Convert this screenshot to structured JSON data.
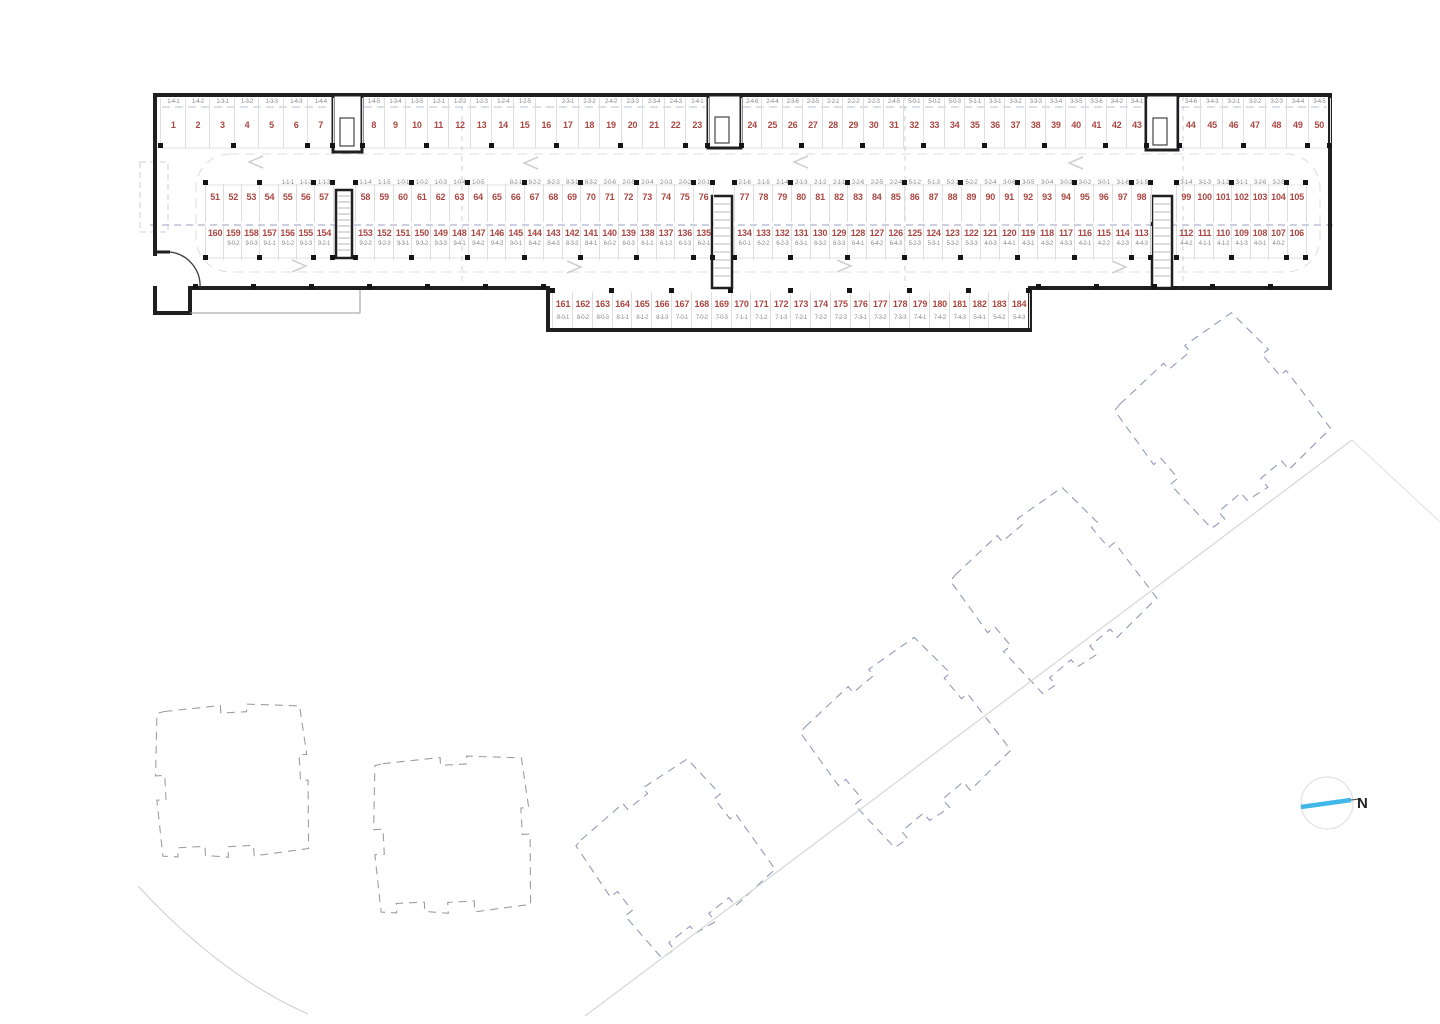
{
  "plan_type": "parking-level-floor-plan",
  "north": {
    "label": "N"
  },
  "colors": {
    "stall_number": "#ab4742",
    "unit_label": "#8c8c8c",
    "walls": "#1f1f1f",
    "stall_separator": "#dedede",
    "upper_floor_dashed": "#98a0c6",
    "site_lines": "#d4d4d4",
    "footprint_left_buildings": "#9e9e9e",
    "footprint_right_buildings": "#939aba",
    "north_arrow": "#41b6e8"
  },
  "parking": {
    "rows": [
      {
        "name": "top-row",
        "label_position": "above",
        "segments": [
          {
            "stalls": [
              {
                "n": "1",
                "u": "1-4-1"
              },
              {
                "n": "2",
                "u": "1-4-2"
              },
              {
                "n": "3",
                "u": "1-3-1"
              },
              {
                "n": "4",
                "u": "1-3-2"
              },
              {
                "n": "5",
                "u": "1-3-3"
              },
              {
                "n": "6",
                "u": "1-4-3"
              },
              {
                "n": "7",
                "u": "1-4-4"
              }
            ]
          },
          {
            "stalls": [
              {
                "n": "8",
                "u": "1-4-5"
              },
              {
                "n": "9",
                "u": "1-3-4"
              },
              {
                "n": "10",
                "u": "1-3-5"
              },
              {
                "n": "11",
                "u": "1-2-1"
              },
              {
                "n": "12",
                "u": "1-2-2"
              },
              {
                "n": "13",
                "u": "1-2-3"
              },
              {
                "n": "14",
                "u": "1-2-4"
              },
              {
                "n": "15",
                "u": "1-2-5"
              },
              {
                "n": "16",
                "u": ""
              },
              {
                "n": "17",
                "u": "2-3-1"
              },
              {
                "n": "18",
                "u": "2-3-2"
              },
              {
                "n": "19",
                "u": "2-4-2"
              },
              {
                "n": "20",
                "u": "2-3-3"
              },
              {
                "n": "21",
                "u": "2-3-4"
              },
              {
                "n": "22",
                "u": "2-4-3"
              },
              {
                "n": "23",
                "u": "2-4-1"
              }
            ]
          },
          {
            "stalls": [
              {
                "n": "24",
                "u": "2-4-6"
              },
              {
                "n": "25",
                "u": "2-4-4"
              },
              {
                "n": "26",
                "u": "2-3-6"
              },
              {
                "n": "27",
                "u": "2-3-5"
              },
              {
                "n": "28",
                "u": "2-2-1"
              },
              {
                "n": "29",
                "u": "2-2-2"
              },
              {
                "n": "30",
                "u": "2-2-3"
              },
              {
                "n": "31",
                "u": "2-4-5"
              },
              {
                "n": "32",
                "u": "5-0-1"
              },
              {
                "n": "33",
                "u": "5-0-2"
              },
              {
                "n": "34",
                "u": "5-0-3"
              },
              {
                "n": "35",
                "u": "5-1-1"
              },
              {
                "n": "36",
                "u": "3-3-1"
              },
              {
                "n": "37",
                "u": "3-3-2"
              },
              {
                "n": "38",
                "u": "3-3-3"
              },
              {
                "n": "39",
                "u": "3-3-4"
              },
              {
                "n": "40",
                "u": "3-3-5"
              },
              {
                "n": "41",
                "u": "3-3-6"
              },
              {
                "n": "42",
                "u": "3-4-2"
              },
              {
                "n": "43",
                "u": "3-4-1"
              }
            ]
          },
          {
            "stalls": [
              {
                "n": "44",
                "u": "3-4-6"
              },
              {
                "n": "45",
                "u": "3-4-3"
              },
              {
                "n": "46",
                "u": "3-2-1"
              },
              {
                "n": "47",
                "u": "3-2-2"
              },
              {
                "n": "48",
                "u": "3-2-3"
              },
              {
                "n": "49",
                "u": "3-4-4"
              },
              {
                "n": "50",
                "u": "3-4-5"
              }
            ]
          }
        ]
      },
      {
        "name": "middle-upper-row",
        "label_position": "above",
        "segments": [
          {
            "stalls": [
              {
                "n": "51",
                "u": ""
              },
              {
                "n": "52",
                "u": ""
              },
              {
                "n": "53",
                "u": ""
              },
              {
                "n": "54",
                "u": ""
              },
              {
                "n": "55",
                "u": "1-1-1"
              },
              {
                "n": "56",
                "u": "1-1-2"
              },
              {
                "n": "57",
                "u": "1-1-3"
              }
            ]
          },
          {
            "stalls": [
              {
                "n": "58",
                "u": "1-1-4"
              },
              {
                "n": "59",
                "u": "1-1-5"
              },
              {
                "n": "60",
                "u": "1-0-1"
              },
              {
                "n": "61",
                "u": "1-0-2"
              },
              {
                "n": "62",
                "u": "1-0-3"
              },
              {
                "n": "63",
                "u": "1-0-4"
              },
              {
                "n": "64",
                "u": "1-0-5"
              },
              {
                "n": "65",
                "u": ""
              },
              {
                "n": "66",
                "u": "8-2-1"
              },
              {
                "n": "67",
                "u": "8-2-2"
              },
              {
                "n": "68",
                "u": "8-2-3"
              },
              {
                "n": "69",
                "u": "8-3-1"
              },
              {
                "n": "70",
                "u": "8-3-2"
              },
              {
                "n": "71",
                "u": "2-0-6"
              },
              {
                "n": "72",
                "u": "2-0-5"
              },
              {
                "n": "73",
                "u": "2-0-4"
              },
              {
                "n": "74",
                "u": "2-0-3"
              },
              {
                "n": "75",
                "u": "2-0-2"
              },
              {
                "n": "76",
                "u": "2-0-1"
              }
            ]
          },
          {
            "stalls": [
              {
                "n": "77",
                "u": "2-1-6"
              },
              {
                "n": "78",
                "u": "2-1-5"
              },
              {
                "n": "79",
                "u": "2-1-4"
              },
              {
                "n": "80",
                "u": "2-1-3"
              },
              {
                "n": "81",
                "u": "2-1-2"
              },
              {
                "n": "82",
                "u": "2-1-1"
              },
              {
                "n": "83",
                "u": "2-2-6"
              },
              {
                "n": "84",
                "u": "2-2-5"
              },
              {
                "n": "85",
                "u": "2-2-4"
              },
              {
                "n": "86",
                "u": "5-1-2"
              },
              {
                "n": "87",
                "u": "5-1-3"
              },
              {
                "n": "88",
                "u": "5-2-1"
              },
              {
                "n": "89",
                "u": "5-2-2"
              },
              {
                "n": "90",
                "u": "3-2-4"
              },
              {
                "n": "91",
                "u": "3-0-6"
              },
              {
                "n": "92",
                "u": "3-0-5"
              },
              {
                "n": "93",
                "u": "3-0-4"
              },
              {
                "n": "94",
                "u": "3-0-3"
              },
              {
                "n": "95",
                "u": "3-0-2"
              },
              {
                "n": "96",
                "u": "3-0-1"
              },
              {
                "n": "97",
                "u": "3-1-6"
              },
              {
                "n": "98",
                "u": "3-1-5"
              }
            ]
          },
          {
            "stalls": [
              {
                "n": "99",
                "u": "3-1-4"
              },
              {
                "n": "100",
                "u": "3-1-3"
              },
              {
                "n": "101",
                "u": "3-1-2"
              },
              {
                "n": "102",
                "u": "3-1-1"
              },
              {
                "n": "103",
                "u": "3-2-6"
              },
              {
                "n": "104",
                "u": "3-2-5"
              },
              {
                "n": "105",
                "u": ""
              }
            ]
          }
        ]
      },
      {
        "name": "middle-lower-row",
        "label_position": "below",
        "segments": [
          {
            "stalls": [
              {
                "n": "160",
                "u": ""
              },
              {
                "n": "159",
                "u": "9-0-2"
              },
              {
                "n": "158",
                "u": "9-0-3"
              },
              {
                "n": "157",
                "u": "9-1-1"
              },
              {
                "n": "156",
                "u": "9-1-2"
              },
              {
                "n": "155",
                "u": "9-1-3"
              },
              {
                "n": "154",
                "u": "9-2-1"
              }
            ]
          },
          {
            "stalls": [
              {
                "n": "153",
                "u": "9-2-2"
              },
              {
                "n": "152",
                "u": "9-2-3"
              },
              {
                "n": "151",
                "u": "9-3-1"
              },
              {
                "n": "150",
                "u": "9-3-2"
              },
              {
                "n": "149",
                "u": "9-3-3"
              },
              {
                "n": "148",
                "u": "9-4-1"
              },
              {
                "n": "147",
                "u": "9-4-2"
              },
              {
                "n": "146",
                "u": "9-4-3"
              },
              {
                "n": "145",
                "u": "9-0-1"
              },
              {
                "n": "144",
                "u": "8-4-2"
              },
              {
                "n": "143",
                "u": "8-4-3"
              },
              {
                "n": "142",
                "u": "8-3-3"
              },
              {
                "n": "141",
                "u": "8-4-1"
              },
              {
                "n": "140",
                "u": "6-0-2"
              },
              {
                "n": "139",
                "u": "6-0-3"
              },
              {
                "n": "138",
                "u": "6-1-1"
              },
              {
                "n": "137",
                "u": "6-1-2"
              },
              {
                "n": "136",
                "u": "6-1-3"
              },
              {
                "n": "135",
                "u": "6-2-1"
              }
            ]
          },
          {
            "stalls": [
              {
                "n": "134",
                "u": "6-0-1"
              },
              {
                "n": "133",
                "u": "6-2-2"
              },
              {
                "n": "132",
                "u": "6-2-3"
              },
              {
                "n": "131",
                "u": "6-3-1"
              },
              {
                "n": "130",
                "u": "6-3-2"
              },
              {
                "n": "129",
                "u": "6-3-3"
              },
              {
                "n": "128",
                "u": "6-4-1"
              },
              {
                "n": "127",
                "u": "6-4-2"
              },
              {
                "n": "126",
                "u": "6-4-3"
              },
              {
                "n": "125",
                "u": "5-2-3"
              },
              {
                "n": "124",
                "u": "5-3-1"
              },
              {
                "n": "123",
                "u": "5-3-2"
              },
              {
                "n": "122",
                "u": "5-3-3"
              },
              {
                "n": "121",
                "u": "4-0-3"
              },
              {
                "n": "120",
                "u": "4-4-1"
              },
              {
                "n": "119",
                "u": "4-3-1"
              },
              {
                "n": "118",
                "u": "4-3-2"
              },
              {
                "n": "117",
                "u": "4-3-3"
              },
              {
                "n": "116",
                "u": "4-2-1"
              },
              {
                "n": "115",
                "u": "4-2-2"
              },
              {
                "n": "114",
                "u": "4-2-3"
              },
              {
                "n": "113",
                "u": "4-4-3"
              }
            ]
          },
          {
            "stalls": [
              {
                "n": "112",
                "u": "4-4-2"
              },
              {
                "n": "111",
                "u": "4-1-1"
              },
              {
                "n": "110",
                "u": "4-1-2"
              },
              {
                "n": "109",
                "u": "4-1-3"
              },
              {
                "n": "108",
                "u": "4-0-1"
              },
              {
                "n": "107",
                "u": "4-0-2"
              },
              {
                "n": "106",
                "u": ""
              }
            ]
          }
        ]
      },
      {
        "name": "bottom-row",
        "label_position": "below",
        "segments": [
          {
            "stalls": [
              {
                "n": "161",
                "u": "8-0-1"
              },
              {
                "n": "162",
                "u": "8-0-2"
              },
              {
                "n": "163",
                "u": "8-0-3"
              },
              {
                "n": "164",
                "u": "8-1-1"
              },
              {
                "n": "165",
                "u": "8-1-2"
              },
              {
                "n": "166",
                "u": "8-1-3"
              },
              {
                "n": "167",
                "u": "7-0-1"
              },
              {
                "n": "168",
                "u": "7-0-2"
              },
              {
                "n": "169",
                "u": "7-0-3"
              },
              {
                "n": "170",
                "u": "7-1-1"
              },
              {
                "n": "171",
                "u": "7-1-2"
              },
              {
                "n": "172",
                "u": "7-1-3"
              },
              {
                "n": "173",
                "u": "7-2-1"
              },
              {
                "n": "174",
                "u": "7-2-2"
              },
              {
                "n": "175",
                "u": "7-2-3"
              },
              {
                "n": "176",
                "u": "7-3-1"
              },
              {
                "n": "177",
                "u": "7-3-2"
              },
              {
                "n": "178",
                "u": "7-3-3"
              },
              {
                "n": "179",
                "u": "7-4-1"
              },
              {
                "n": "180",
                "u": "7-4-2"
              },
              {
                "n": "181",
                "u": "7-4-3"
              },
              {
                "n": "182",
                "u": "5-4-1"
              },
              {
                "n": "183",
                "u": "5-4-2"
              },
              {
                "n": "184",
                "u": "5-4-3"
              }
            ]
          }
        ]
      }
    ]
  }
}
